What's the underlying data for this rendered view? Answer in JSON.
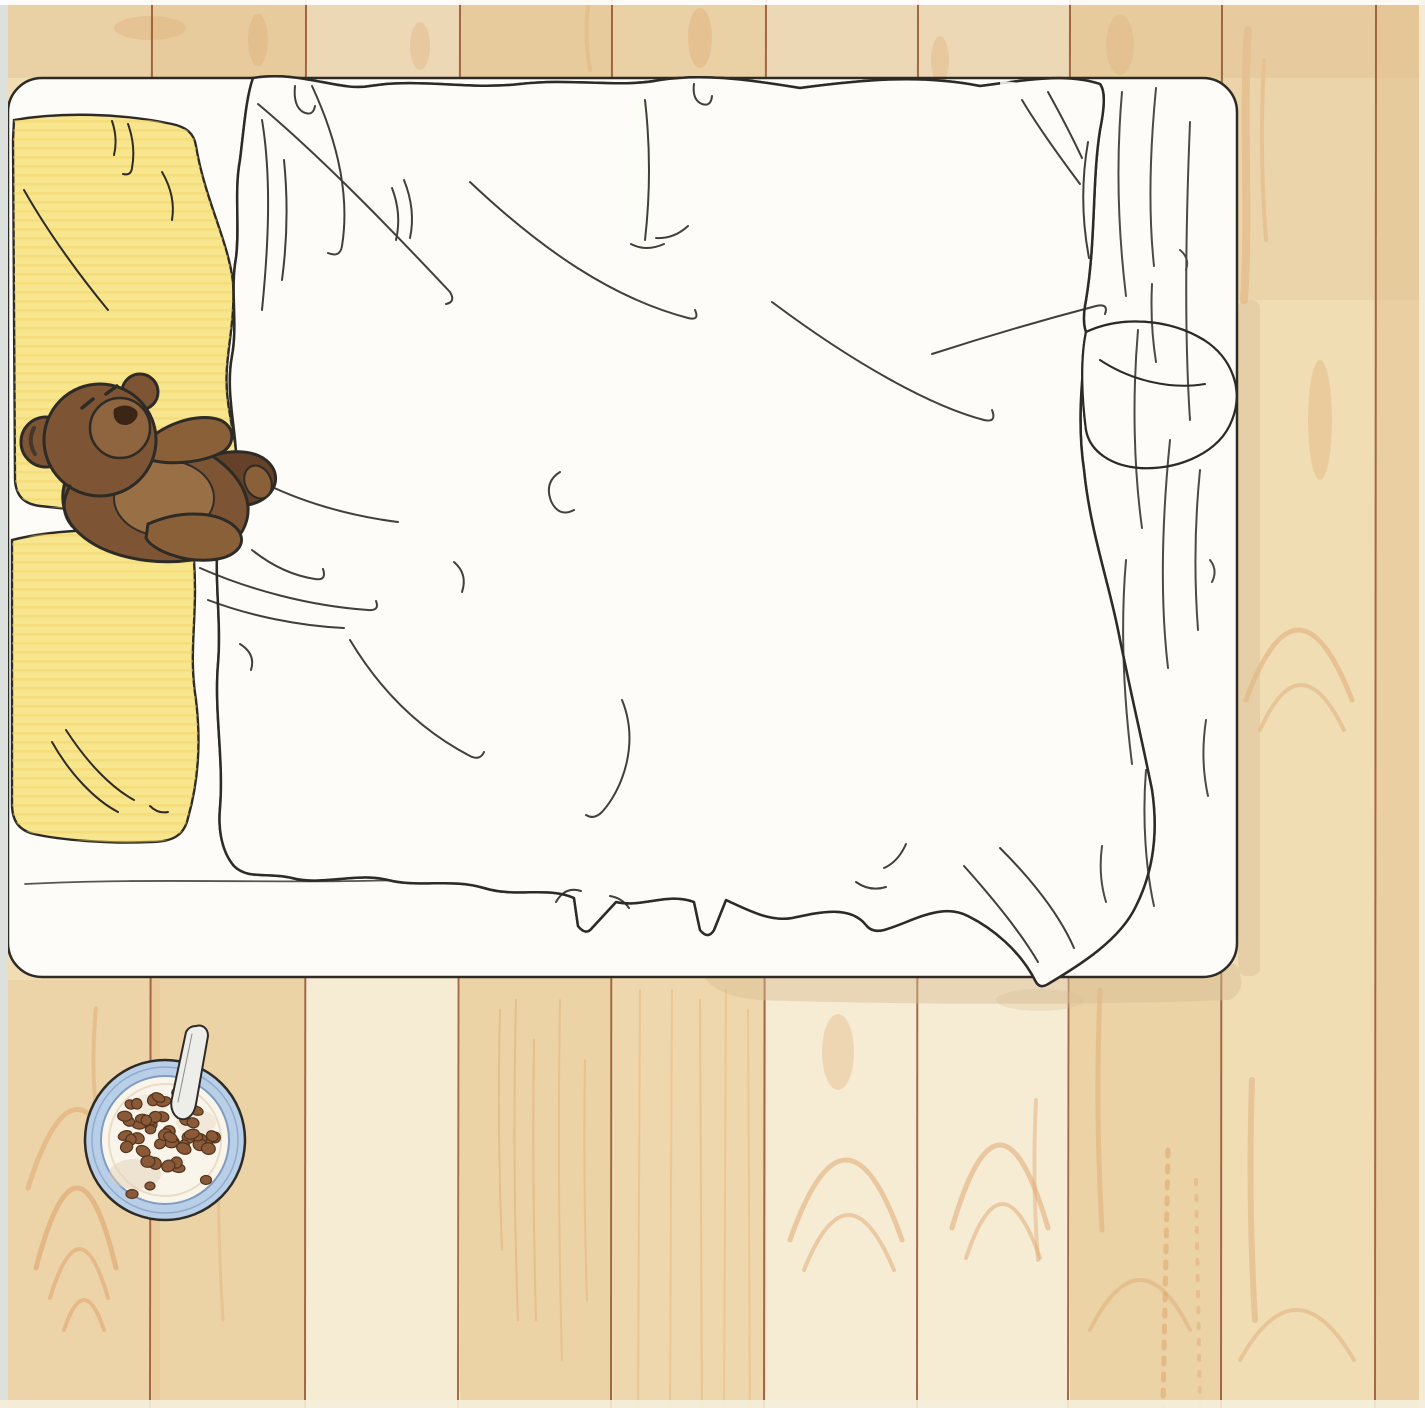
{
  "meta": {
    "kind": "hand-drawn marker illustration",
    "view": "top-down"
  },
  "scene": {
    "description": "Top-down view of a bed with a yellow checkered duvet and yellow pillows on a wooden plank floor; a brown teddy bear lies on the pillows and a bowl of cereal with a spoon sits on the floor below the bed",
    "objects": {
      "floor": {
        "type": "wood-planks",
        "plank_orientation": "vertical",
        "plank_count": 10
      },
      "bed": {
        "mattress_color_name": "white",
        "position": "top-left"
      },
      "pillows": {
        "count": 2,
        "color_name": "yellow"
      },
      "duvet": {
        "pattern": "checkerboard",
        "pattern_colors": [
          "yellow",
          "white"
        ]
      },
      "folded_sheet": {
        "color_name": "white",
        "position": "right-of-duvet",
        "texture": "wrinkled line-work"
      },
      "teddy_bear": {
        "color_name": "brown",
        "pose": "lying-on-pillows",
        "eyes": "closed"
      },
      "cereal_bowl": {
        "contents": "cereal-and-milk",
        "rim_color_name": "light-blue",
        "has_spoon": true,
        "position": "floor-below-bed"
      }
    }
  },
  "colors": {
    "paper-white": "#fdfcf8",
    "ink": "#2e2b26",
    "floor-base": "#f1debb",
    "floor-light": "#f6ecd4",
    "floor-mid": "#f0ddb4",
    "floor-deep": "#ebd3a6",
    "floor-shade": "#e2c193",
    "plank-line": "#8f4b2a",
    "grain": "#dda268",
    "shadow-tan": "#d8bc92",
    "pillow-yellow": "#f8e68f",
    "pillow-streak": "#f0d express",
    "pillow-streak-yellow": "#efd express",
    "pillow-streak-col": "#efd25f",
    "duvet-yellow": "#f4db80",
    "duvet-yellow-deep": "#e9c967",
    "bear-main": "#7d5534",
    "bear-mid": "#8a6038",
    "bear-dark": "#66412a",
    "bear-belly": "#9b7148",
    "bear-muzzle": "#8f653f",
    "bear-nose": "#3a2517",
    "bowl-blue": "#b9cfe7",
    "bowl-blue-dark": "#7f9cc0",
    "milk-white": "#faf5ea",
    "milk-shade": "#e2d2b8",
    "cereal-brown": "#8a5a38",
    "cereal-dark": "#53331d",
    "spoon-grey": "#ededea",
    "scan-edge": "#dde1dd"
  }
}
